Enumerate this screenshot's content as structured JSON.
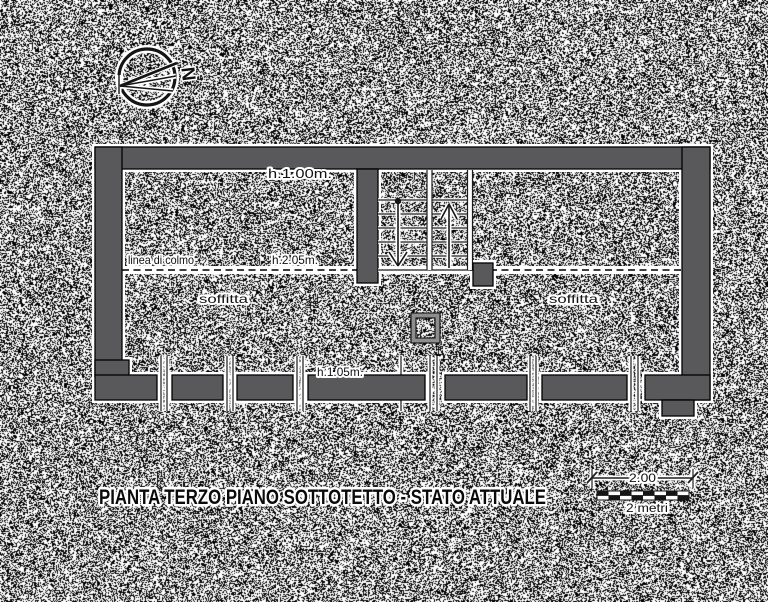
{
  "drawing": {
    "title": "PIANTA TERZO PIANO SOTTOTETTO - STATO ATTUALE",
    "compass": {
      "north": "N"
    },
    "plan_labels": {
      "h_top": "h.1.00m.",
      "ridge": "linea di colmo",
      "h_ridge": "h.2.05m.",
      "soffitta_left": "soffitta",
      "soffitta_right": "soffitta",
      "h_bottom": "h.1.05m."
    },
    "scale_bar": {
      "value": "2.00",
      "caption": "2 metri"
    },
    "colors": {
      "wall_fill": "#59595b",
      "outline": "#000000",
      "halo": "#ffffff",
      "annotation": "#111111"
    }
  }
}
